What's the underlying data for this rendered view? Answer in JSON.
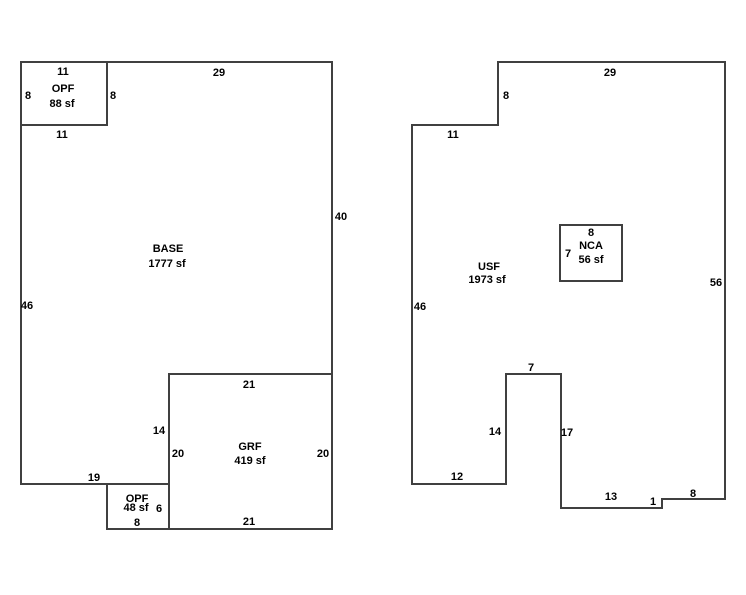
{
  "canvas": {
    "width": 746,
    "height": 595,
    "background": "#ffffff",
    "line_color": "#404040",
    "line_width": 2,
    "text_color": "#000000",
    "font_size": 11
  },
  "sketch": {
    "figures": [
      {
        "id": "left-floorplan",
        "areas": [
          {
            "name": "OPF",
            "size": "88 sf"
          },
          {
            "name": "BASE",
            "size": "1777 sf"
          },
          {
            "name": "GRF",
            "size": "419 sf"
          },
          {
            "name": "OPF",
            "size": "48 sf"
          }
        ],
        "segments": [
          [
            21,
            62,
            332,
            62
          ],
          [
            332,
            62,
            332,
            529
          ],
          [
            332,
            529,
            107,
            529
          ],
          [
            107,
            529,
            107,
            484
          ],
          [
            169,
            484,
            21,
            484
          ],
          [
            21,
            484,
            21,
            62
          ],
          [
            107,
            62,
            107,
            125
          ],
          [
            107,
            125,
            21,
            125
          ],
          [
            169,
            374,
            332,
            374
          ],
          [
            169,
            374,
            169,
            529
          ]
        ],
        "labels": [
          {
            "text": "11",
            "x": 63,
            "y": 71,
            "kind": "dim"
          },
          {
            "text": "OPF",
            "x": 63,
            "y": 88,
            "kind": "area-name"
          },
          {
            "text": "88 sf",
            "x": 62,
            "y": 103,
            "kind": "area-size"
          },
          {
            "text": "8",
            "x": 28,
            "y": 95,
            "kind": "dim"
          },
          {
            "text": "8",
            "x": 113,
            "y": 95,
            "kind": "dim"
          },
          {
            "text": "29",
            "x": 219,
            "y": 72,
            "kind": "dim"
          },
          {
            "text": "11",
            "x": 62,
            "y": 134,
            "kind": "dim"
          },
          {
            "text": "40",
            "x": 341,
            "y": 216,
            "kind": "dim"
          },
          {
            "text": "BASE",
            "x": 168,
            "y": 248,
            "kind": "area-name"
          },
          {
            "text": "1777 sf",
            "x": 167,
            "y": 263,
            "kind": "area-size"
          },
          {
            "text": "46",
            "x": 27,
            "y": 305,
            "kind": "dim"
          },
          {
            "text": "21",
            "x": 249,
            "y": 384,
            "kind": "dim"
          },
          {
            "text": "14",
            "x": 159,
            "y": 430,
            "kind": "dim"
          },
          {
            "text": "20",
            "x": 178,
            "y": 453,
            "kind": "dim"
          },
          {
            "text": "GRF",
            "x": 250,
            "y": 446,
            "kind": "area-name"
          },
          {
            "text": "419 sf",
            "x": 250,
            "y": 460,
            "kind": "area-size"
          },
          {
            "text": "20",
            "x": 323,
            "y": 453,
            "kind": "dim"
          },
          {
            "text": "19",
            "x": 94,
            "y": 477,
            "kind": "dim"
          },
          {
            "text": "OPF",
            "x": 137,
            "y": 498,
            "kind": "area-name"
          },
          {
            "text": "48 sf",
            "x": 136,
            "y": 507,
            "kind": "area-size"
          },
          {
            "text": "6",
            "x": 159,
            "y": 508,
            "kind": "dim"
          },
          {
            "text": "8",
            "x": 137,
            "y": 522,
            "kind": "dim"
          },
          {
            "text": "21",
            "x": 249,
            "y": 521,
            "kind": "dim"
          }
        ]
      },
      {
        "id": "right-floorplan",
        "areas": [
          {
            "name": "USF",
            "size": "1973 sf"
          },
          {
            "name": "NCA",
            "size": "56 sf"
          }
        ],
        "segments": [
          [
            498,
            62,
            725,
            62
          ],
          [
            725,
            62,
            725,
            499
          ],
          [
            725,
            499,
            662,
            499
          ],
          [
            662,
            499,
            662,
            508
          ],
          [
            662,
            508,
            561,
            508
          ],
          [
            561,
            508,
            561,
            374
          ],
          [
            561,
            374,
            506,
            374
          ],
          [
            506,
            374,
            506,
            484
          ],
          [
            506,
            484,
            412,
            484
          ],
          [
            412,
            484,
            412,
            125
          ],
          [
            412,
            125,
            498,
            125
          ],
          [
            498,
            125,
            498,
            62
          ],
          [
            560,
            225,
            622,
            225
          ],
          [
            622,
            225,
            622,
            281
          ],
          [
            622,
            281,
            560,
            281
          ],
          [
            560,
            281,
            560,
            225
          ]
        ],
        "labels": [
          {
            "text": "29",
            "x": 610,
            "y": 72,
            "kind": "dim"
          },
          {
            "text": "8",
            "x": 506,
            "y": 95,
            "kind": "dim"
          },
          {
            "text": "11",
            "x": 453,
            "y": 134,
            "kind": "dim"
          },
          {
            "text": "56",
            "x": 716,
            "y": 282,
            "kind": "dim"
          },
          {
            "text": "46",
            "x": 420,
            "y": 306,
            "kind": "dim"
          },
          {
            "text": "USF",
            "x": 489,
            "y": 266,
            "kind": "area-name"
          },
          {
            "text": "1973 sf",
            "x": 487,
            "y": 279,
            "kind": "area-size"
          },
          {
            "text": "8",
            "x": 591,
            "y": 232,
            "kind": "dim"
          },
          {
            "text": "NCA",
            "x": 591,
            "y": 245,
            "kind": "area-name"
          },
          {
            "text": "7",
            "x": 568,
            "y": 253,
            "kind": "dim"
          },
          {
            "text": "56 sf",
            "x": 591,
            "y": 259,
            "kind": "area-size"
          },
          {
            "text": "7",
            "x": 531,
            "y": 367,
            "kind": "dim"
          },
          {
            "text": "14",
            "x": 495,
            "y": 431,
            "kind": "dim"
          },
          {
            "text": "17",
            "x": 567,
            "y": 432,
            "kind": "dim"
          },
          {
            "text": "12",
            "x": 457,
            "y": 476,
            "kind": "dim"
          },
          {
            "text": "13",
            "x": 611,
            "y": 496,
            "kind": "dim"
          },
          {
            "text": "1",
            "x": 653,
            "y": 501,
            "kind": "dim"
          },
          {
            "text": "8",
            "x": 693,
            "y": 493,
            "kind": "dim"
          }
        ]
      }
    ]
  }
}
